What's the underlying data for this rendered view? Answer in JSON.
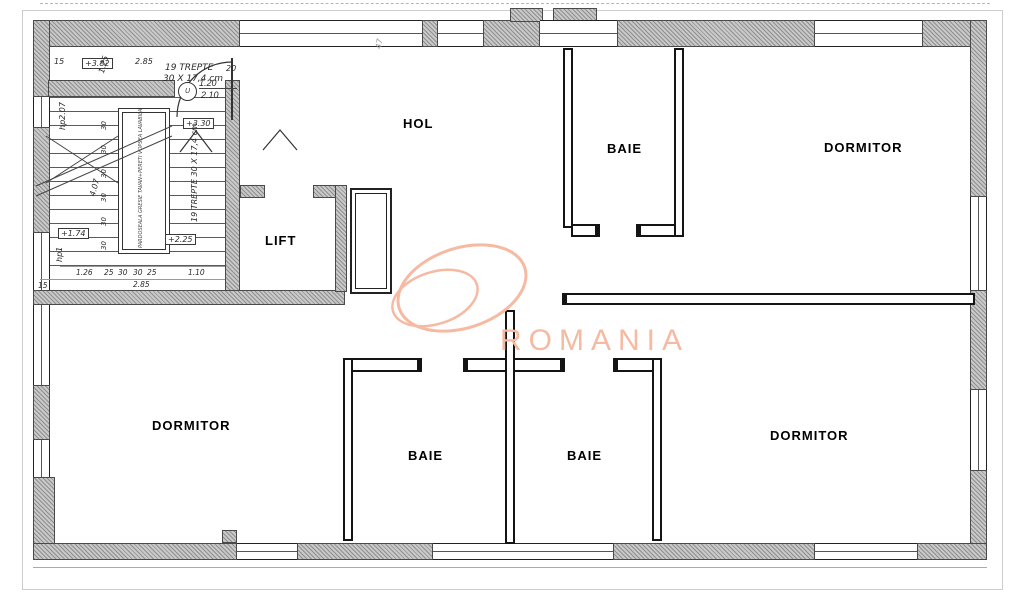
{
  "watermark": {
    "text": "ROMANIA",
    "color": "#f6b9a2"
  },
  "colors": {
    "watermark": "#f6b9a2",
    "wall_hatch": "#9a9a9a",
    "line": "#1a1a1a"
  },
  "rooms": {
    "hol": "HOL",
    "baie_top": "BAIE",
    "dormitor_top_right": "DORMITOR",
    "lift": "LIFT",
    "dormitor_bottom_left": "DORMITOR",
    "baie_bottom_left": "BAIE",
    "baie_bottom_right": "BAIE",
    "dormitor_bottom_right": "DORMITOR"
  },
  "stairs": {
    "treads_line1": "19 TREPTE",
    "treads_line2": "30 X 17,4 cm",
    "treads_rotated": "19 TREPTE 30 X 17,4 cm",
    "landing_note": "PARDOSEALA GRESIE TAVAN+PERETI VOPSEA LAVABILA",
    "tread_depth": "30"
  },
  "levels": {
    "l_382": "+3.82",
    "l_330": "+3.30",
    "l_225": "+2.25",
    "l_174": "+1.74"
  },
  "door_tag": {
    "symbol": "U",
    "w": "1.20",
    "h": "2.10"
  },
  "dims": {
    "d285": "2.85",
    "d20": "20",
    "d15": "15",
    "d125": "1.25",
    "hp2": "hp2.07",
    "d407": "4.07",
    "hp1": "hp1",
    "d126": "1.26",
    "d25": "25",
    "d30": "30",
    "d110": "1.10",
    "d285b": "2.85",
    "d15b": "15",
    "d47": "47"
  }
}
